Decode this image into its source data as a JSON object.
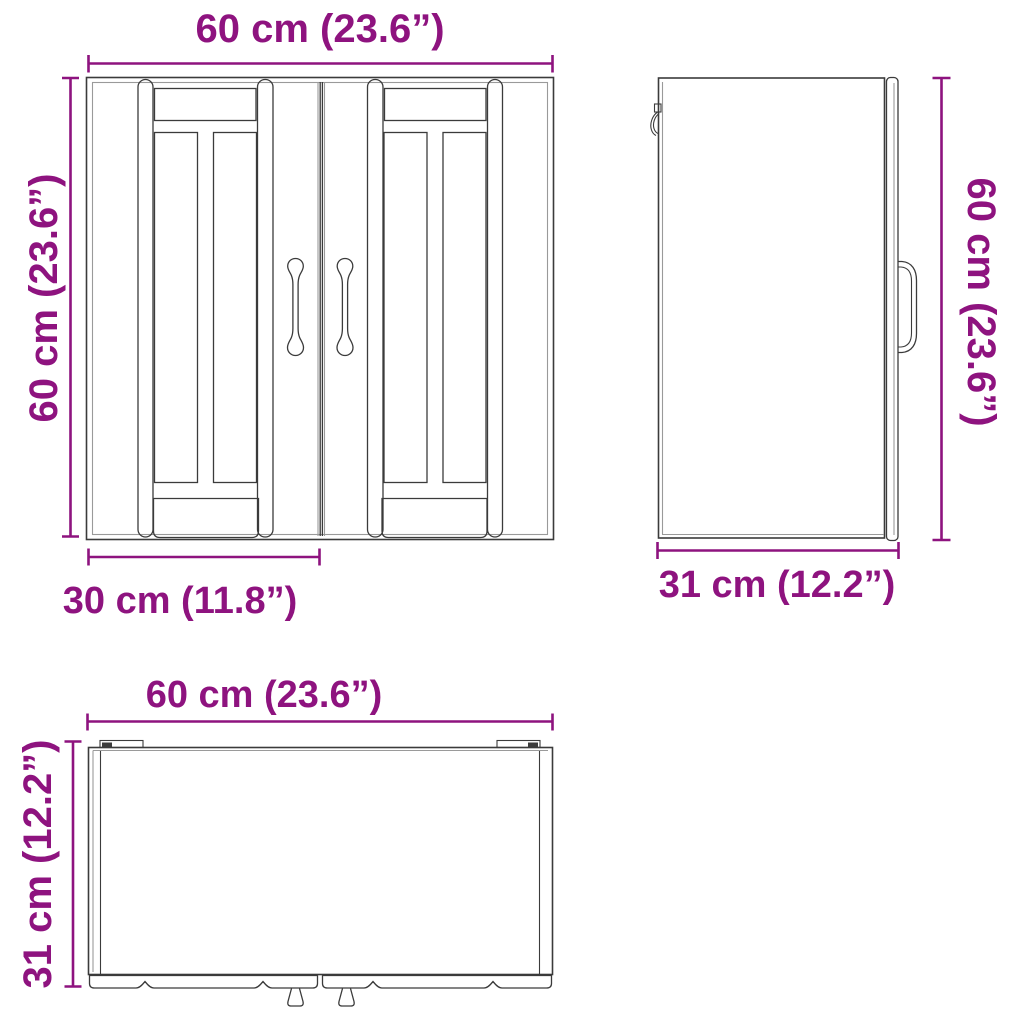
{
  "colors": {
    "accent": "#8E137F",
    "line": "#3B3B3B",
    "line_light": "#9A9A9A",
    "background": "#FFFFFF"
  },
  "dimensions": {
    "width_cm": 60,
    "width_in": 23.6,
    "height_cm": 60,
    "height_in": 23.6,
    "depth_cm": 31,
    "depth_in": 12.2,
    "door_width_cm": 30,
    "door_width_in": 11.8
  },
  "views": {
    "front": {
      "width_label": "60 cm (23.6”)",
      "height_label": "60 cm (23.6”)",
      "door_width_label": "30 cm (11.8”)"
    },
    "side": {
      "height_label": "60 cm (23.6”)",
      "depth_label": "31 cm (12.2”)"
    },
    "top": {
      "width_label": "60 cm (23.6”)",
      "depth_label": "31 cm (12.2”)"
    }
  }
}
